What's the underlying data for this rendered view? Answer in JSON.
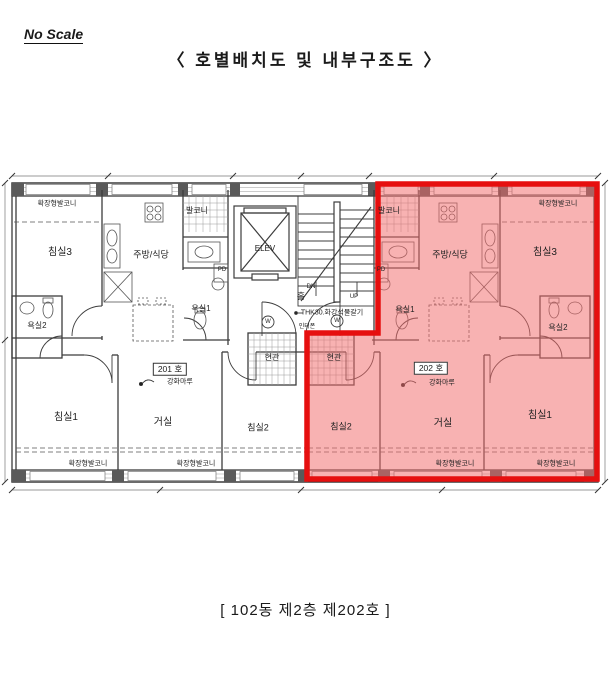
{
  "header": {
    "no_scale": "No Scale",
    "title": "〈 호별배치도 및 내부구조도 〉"
  },
  "caption": "[ 102동 제2층 제202호 ]",
  "colors": {
    "highlight_fill": "#F26B6B",
    "highlight_border": "#E60F0F",
    "wall_line": "#3c3c3c"
  },
  "core": {
    "elevator": "ELEV",
    "stairs_down": "DN",
    "stairs_up": "UP",
    "hall": "홀",
    "hall_finish": "THK30.화강석물갈기",
    "intercom": "인터폰",
    "duct_left": "PD",
    "duct_right": "PD",
    "door_mark_left": "W",
    "door_mark_right": "W"
  },
  "units": {
    "left": {
      "number_label": "201 호",
      "floor_label": "강화마루",
      "rooms": {
        "ext_balcony_top": "확장형발코니",
        "bedroom3": "침실3",
        "kitchen": "주방/식당",
        "balcony": "발코니",
        "bath1": "욕실1",
        "bath2": "욕실2",
        "bedroom1": "침실1",
        "living": "거실",
        "bedroom2": "침실2",
        "entrance": "현관",
        "ext_balcony_bottom1": "확장형발코니",
        "ext_balcony_bottom2": "확장형발코니"
      }
    },
    "right": {
      "number_label": "202 호",
      "floor_label": "강화마루",
      "rooms": {
        "ext_balcony_top": "확장형발코니",
        "bedroom3": "침실3",
        "kitchen": "주방/식당",
        "balcony": "발코니",
        "bath1": "욕실1",
        "bath2": "욕실2",
        "bedroom1": "침실1",
        "living": "거실",
        "bedroom2": "침실2",
        "entrance": "현관",
        "ext_balcony_bottom1": "확장형발코니",
        "ext_balcony_bottom2": "확장형발코니"
      }
    }
  }
}
